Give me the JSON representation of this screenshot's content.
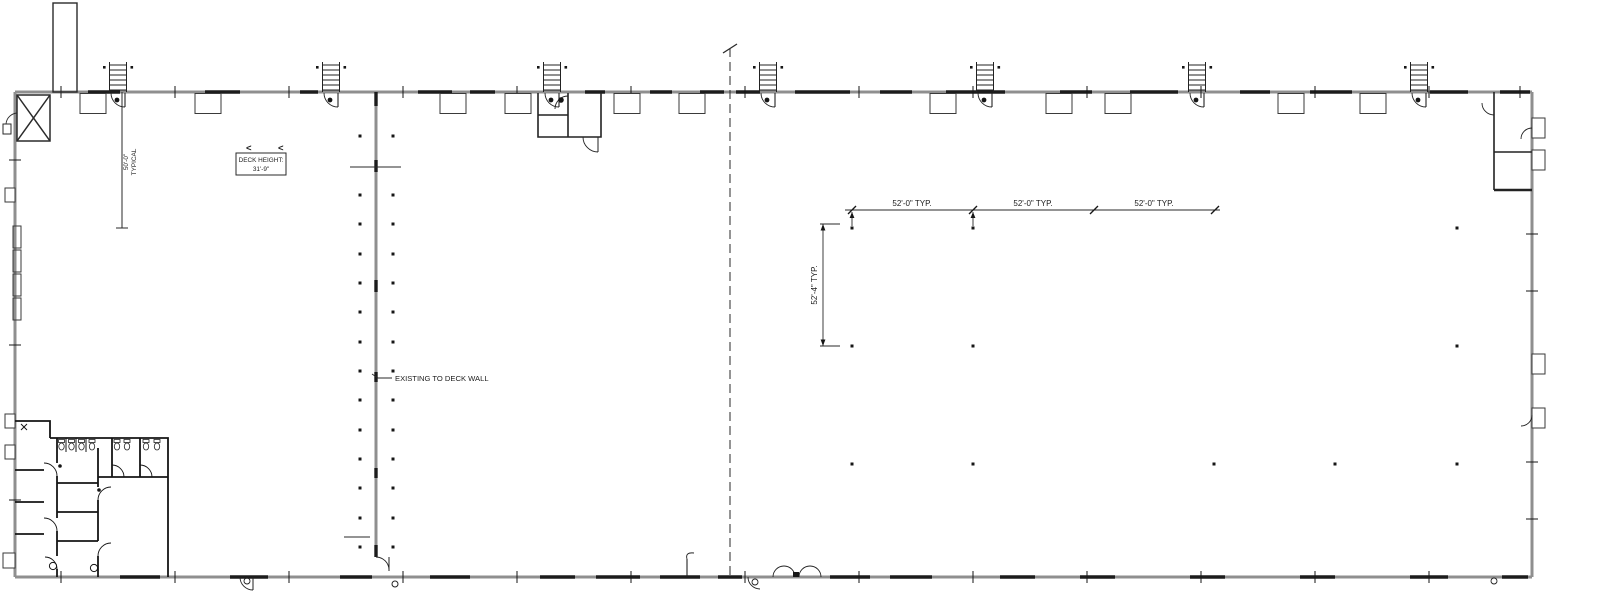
{
  "annotations": {
    "deck_height": {
      "line1": "DECK HEIGHT:",
      "line2": "31'-9\""
    },
    "slope_arrows": [
      "<",
      "<"
    ],
    "typical_height": {
      "line1": "50'-0\"",
      "line2": "TYPICAL"
    },
    "existing_note": "EXISTING TO DECK WALL",
    "bay_dims": [
      "52'-0\" TYP.",
      "52'-0\" TYP.",
      "52'-0\" TYP."
    ],
    "bay_dim_vertical": "52'-4\" TYP."
  },
  "colors": {
    "wall_gray": "#8f8f8f",
    "line_black": "#1c1c1c",
    "background": "#ffffff"
  }
}
